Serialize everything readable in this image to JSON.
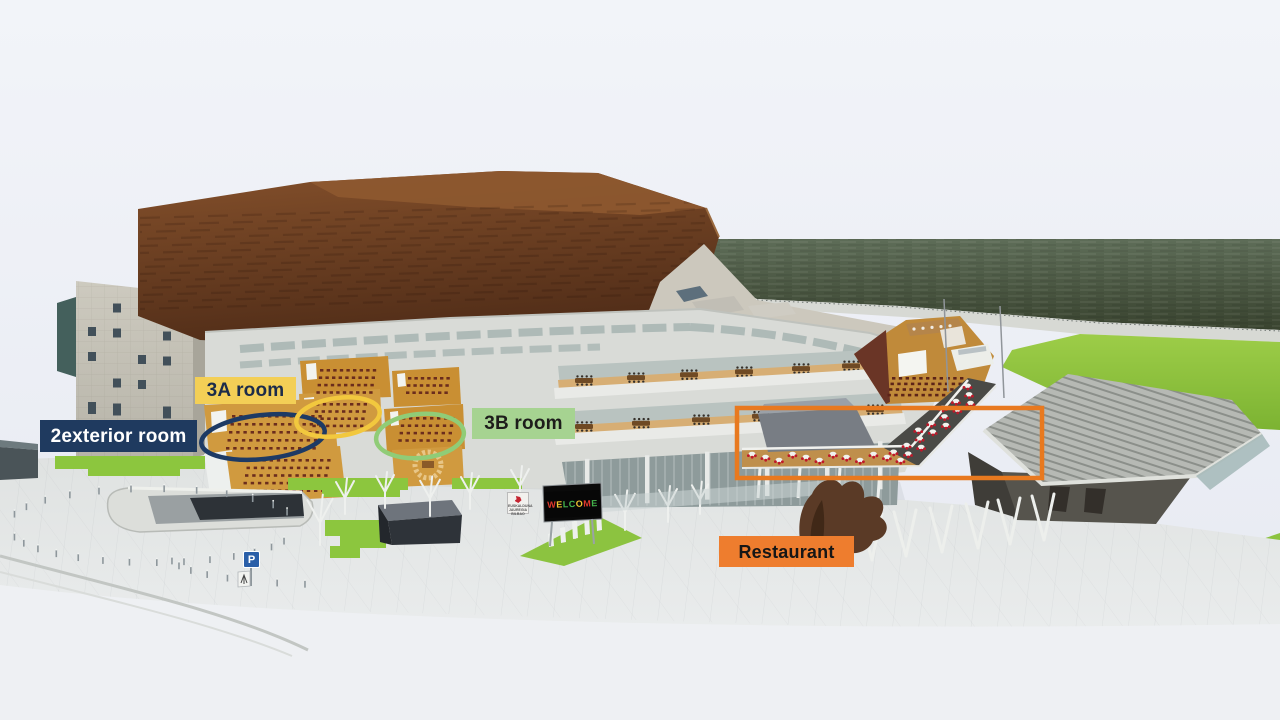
{
  "labels": {
    "room_2exterior": {
      "text": "2exterior room",
      "bg": "#1f3a5f",
      "fg": "#ffffff"
    },
    "room_3a": {
      "text": "3A room",
      "bg": "#f3cf56",
      "fg": "#1c2c4a"
    },
    "room_3b": {
      "text": "3B room",
      "bg": "#a6d391",
      "fg": "#1d1d1b"
    },
    "restaurant": {
      "text": "Restaurant",
      "bg": "#ee7d2e",
      "fg": "#161616"
    }
  },
  "highlights": {
    "ellipse_2exterior": {
      "shape": "ellipse",
      "color": "#1d3a64"
    },
    "ellipse_3a": {
      "shape": "ellipse",
      "color": "#f2c83e"
    },
    "ellipse_3b": {
      "shape": "ellipse",
      "color": "#90cc77"
    },
    "rect_restaurant": {
      "shape": "rectangle",
      "color": "#e8791f"
    }
  },
  "signage": {
    "welcome_letters": [
      [
        "W",
        "#e0392c"
      ],
      [
        "E",
        "#f2c531"
      ],
      [
        "L",
        "#43b14b"
      ],
      [
        "C",
        "#43b14b"
      ],
      [
        "O",
        "#f2c531"
      ],
      [
        "M",
        "#e0392c"
      ],
      [
        "E",
        "#43b14b"
      ]
    ],
    "venue_sign": "EUSKALDUNA JAUREGIA BILBAO",
    "parking": "P"
  },
  "palette": {
    "sky": "#eaedf4",
    "water": "#4a5745",
    "lawn": "#8cc63e",
    "corten": "#6e4023",
    "facade": "#d9dbd7",
    "plaza": "#e4e6e5"
  }
}
